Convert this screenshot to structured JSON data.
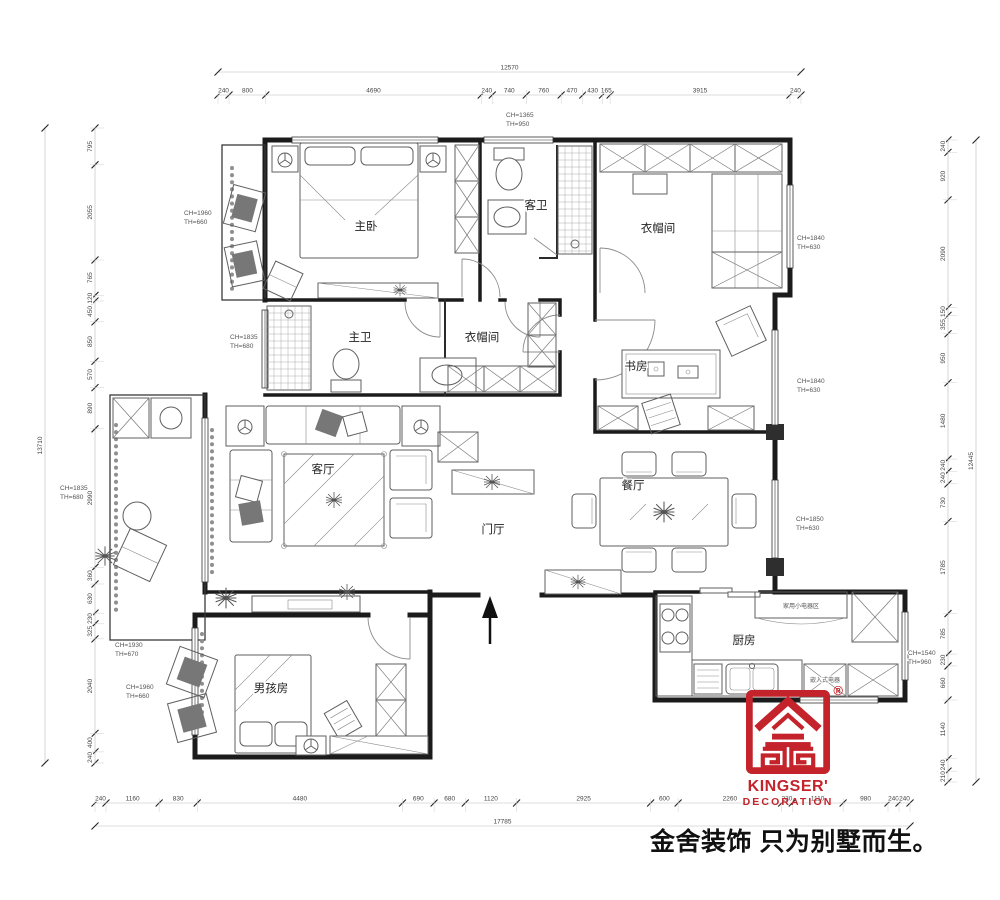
{
  "rooms": [
    {
      "name": "master-bedroom",
      "label": "主卧"
    },
    {
      "name": "guest-bathroom",
      "label": "客卫"
    },
    {
      "name": "cloakroom-top",
      "label": "衣帽间"
    },
    {
      "name": "master-bathroom",
      "label": "主卫"
    },
    {
      "name": "cloakroom-middle",
      "label": "衣帽间"
    },
    {
      "name": "study",
      "label": "书房"
    },
    {
      "name": "living-room",
      "label": "客厅"
    },
    {
      "name": "entrance-hall",
      "label": "门厅"
    },
    {
      "name": "dining-room",
      "label": "餐厅"
    },
    {
      "name": "kitchen",
      "label": "厨房"
    },
    {
      "name": "boys-room",
      "label": "男孩房"
    }
  ],
  "kitchen_notes": [
    {
      "name": "small-appliance-area",
      "label": "家用小电器区"
    },
    {
      "name": "built-in-appliance",
      "label": "嵌入式电器"
    }
  ],
  "annotations": [
    {
      "location": "top-window",
      "ch": "CH=1365",
      "th": "TH=950"
    },
    {
      "location": "master-balcony",
      "ch": "CH=1960",
      "th": "TH=660"
    },
    {
      "location": "master-bath",
      "ch": "CH=1835",
      "th": "TH=680"
    },
    {
      "location": "cloakroom-right",
      "ch": "CH=1840",
      "th": "TH=630"
    },
    {
      "location": "study-right",
      "ch": "CH=1840",
      "th": "TH=630"
    },
    {
      "location": "dining-right",
      "ch": "CH=1850",
      "th": "TH=630"
    },
    {
      "location": "living-left",
      "ch": "CH=1835",
      "th": "TH=680"
    },
    {
      "location": "boys-left-upper",
      "ch": "CH=1930",
      "th": "TH=670"
    },
    {
      "location": "boys-left-lower",
      "ch": "CH=1960",
      "th": "TH=660"
    },
    {
      "location": "kitchen-right",
      "ch": "CH=1540",
      "th": "TH=960"
    }
  ],
  "dimensions": {
    "top": {
      "overall": "12570",
      "segments": [
        "240",
        "800",
        "4690",
        "240",
        "740",
        "760",
        "470",
        "430",
        "165",
        "3915",
        "240"
      ]
    },
    "bottom": {
      "overall": "17785",
      "segments": [
        "240",
        "1160",
        "830",
        "4480",
        "690",
        "680",
        "1120",
        "2925",
        "600",
        "2260",
        "230",
        "1110",
        "980",
        "240",
        "240"
      ]
    },
    "left": {
      "overall": "13710",
      "segments": [
        "795",
        "2055",
        "765",
        "120",
        "450",
        "850",
        "570",
        "890",
        "2990",
        "360",
        "630",
        "230",
        "325",
        "2040",
        "400",
        "240"
      ]
    },
    "right": {
      "overall": "12445",
      "segments": [
        "240",
        "920",
        "2090",
        "150",
        "355",
        "950",
        "1480",
        "240",
        "240",
        "730",
        "1785",
        "785",
        "230",
        "660",
        "1140",
        "240",
        "210"
      ]
    }
  },
  "branding": {
    "logo_text_line1": "KINGSER'",
    "logo_text_line2": "DECORATION",
    "registered": "®",
    "slogan": "金舍装饰 只为别墅而生。",
    "logo_color": "#c4232b"
  }
}
